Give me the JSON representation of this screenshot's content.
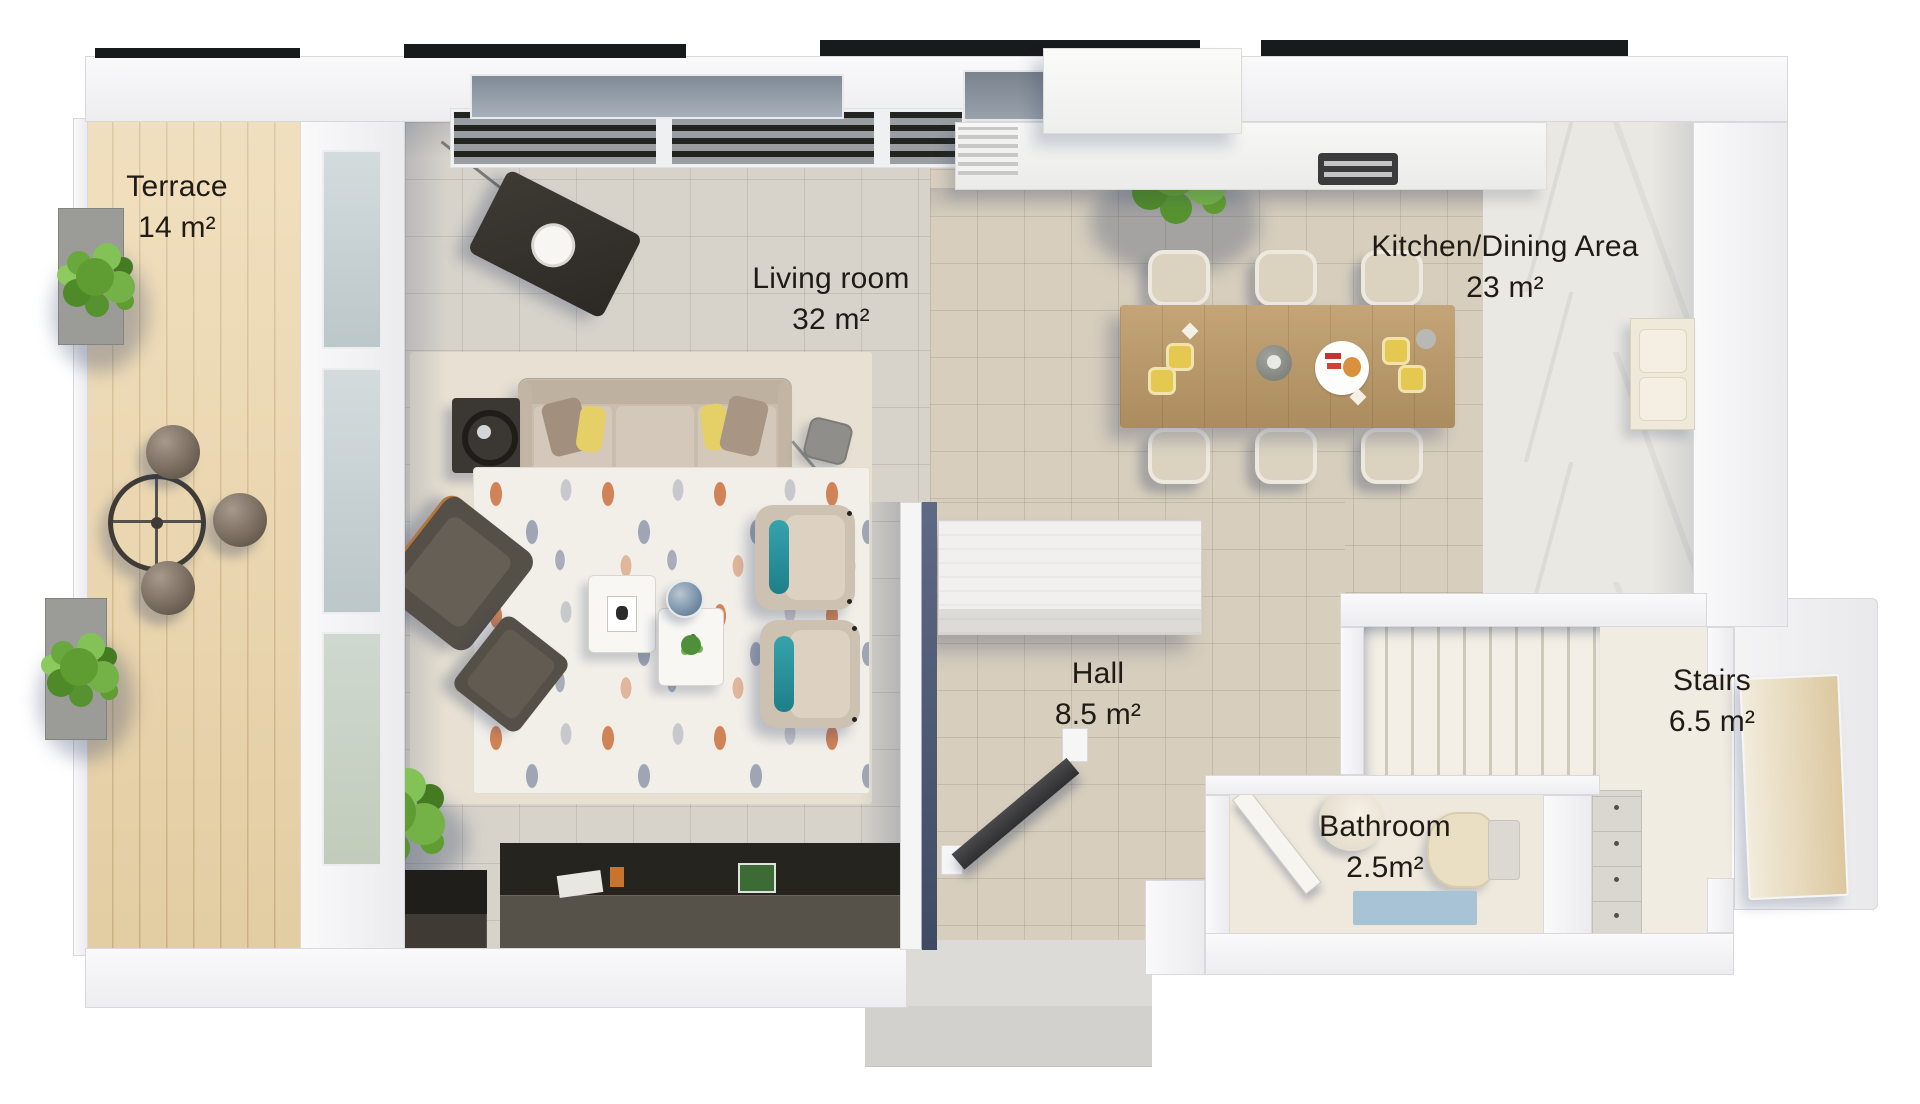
{
  "rooms": [
    {
      "id": "terrace",
      "label": "Terrace",
      "area": "14 m²"
    },
    {
      "id": "living-room",
      "label": "Living room",
      "area": "32 m²"
    },
    {
      "id": "kitchen-dining",
      "label": "Kitchen/Dining Area",
      "area": "23 m²"
    },
    {
      "id": "hall",
      "label": "Hall",
      "area": "8.5 m²"
    },
    {
      "id": "bathroom",
      "label": "Bathroom",
      "area": "2.5m²"
    },
    {
      "id": "stairs",
      "label": "Stairs",
      "area": "6.5 m²"
    }
  ],
  "palette": {
    "label_text": "#1f1b16",
    "wood_deck": "#ecd5a9",
    "tile_living": "#d7d3cb",
    "tile_kitchen": "#d7cebd",
    "floor_cream": "#f1ece2",
    "wall_white": "#f5f5f6",
    "accent_teal": "#2f9aa4",
    "accent_orange": "#c8742e",
    "accent_yellow": "#e5cf67",
    "plant_green": "#6aa840",
    "shadow_navy": "#2d3e64"
  }
}
